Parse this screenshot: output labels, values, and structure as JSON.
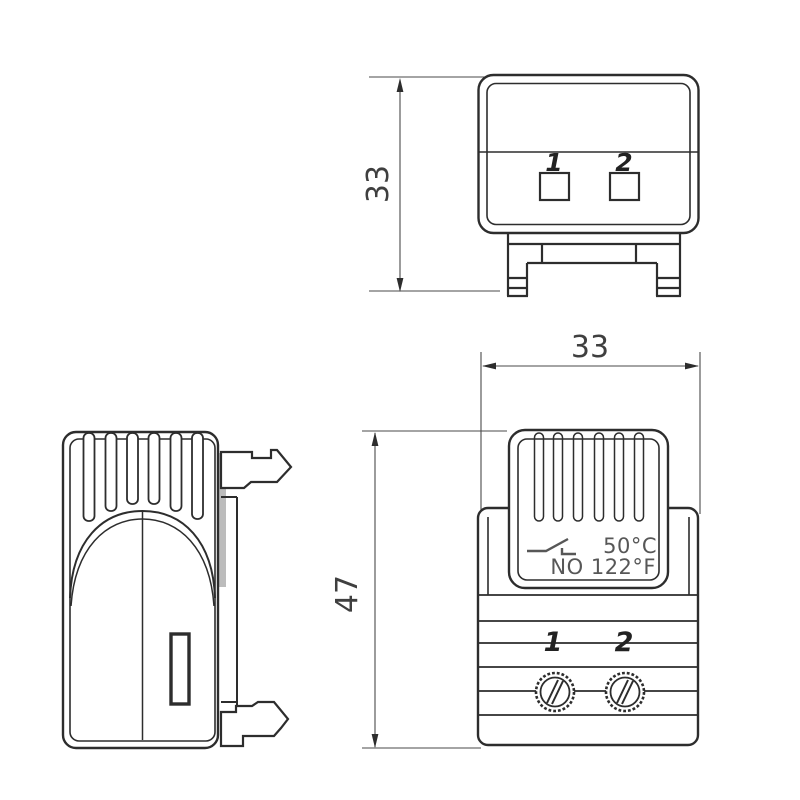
{
  "drawing": {
    "description": "Three-view technical dimension drawing of a DIN-rail mount enclosure thermostat",
    "colors": {
      "background": "#ffffff",
      "line": "#2d2d2d",
      "dimension": "#4a4a4a",
      "vent_fill": "#c3c3c3",
      "shade_fill": "#bcbcbc",
      "rating_text": "#575757"
    },
    "views": {
      "top_view": {
        "name": "top view",
        "dimension_depth": "33",
        "terminals": [
          "1",
          "2"
        ]
      },
      "front_view": {
        "name": "front view",
        "dimension_width": "33",
        "dimension_height": "47",
        "rating_line1": "50°C",
        "rating_line2": "NO 122°F",
        "terminals": [
          "1",
          "2"
        ]
      },
      "side_view": {
        "name": "side view"
      }
    }
  }
}
